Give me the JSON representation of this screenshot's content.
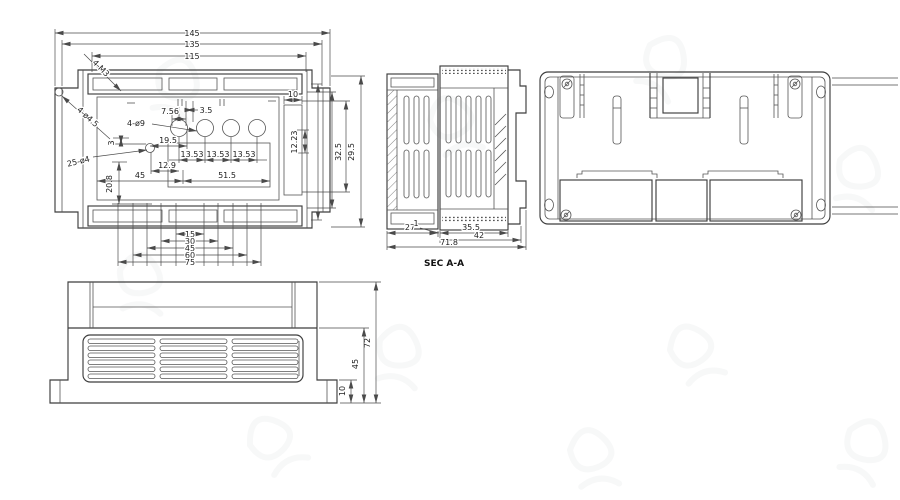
{
  "top_view": {
    "dim_145": "145",
    "dim_135": "135",
    "dim_115": "115",
    "leader_4_m3": "4-M3",
    "leader_4_d4_5": "4-ø4.5",
    "leader_4_d9": "4-ø9",
    "leader_25_d4": "25-ø4",
    "dim_7_56": "7.56",
    "dim_3_5": "3.5",
    "dim_3": "3",
    "dim_19_5": "19.5",
    "dim_20_8": "20.8",
    "dim_pitch_1": "13.53",
    "dim_pitch_2": "13.53",
    "dim_pitch_3": "13.53",
    "dim_12_9": "12.9",
    "dim_45": "45",
    "dim_51_5": "51.5",
    "dim_10": "10",
    "dim_12_23": "12.23",
    "dim_v1": "32.5",
    "dim_v2": "29.5",
    "stack": [
      "15",
      "30",
      "45",
      "60",
      "75"
    ]
  },
  "section_view": {
    "dim_27": "27",
    "dim_1": "1",
    "dim_35_5": "35.5",
    "dim_42": "42",
    "dim_71_8": "71.8",
    "label": "SEC A-A"
  },
  "front_view": {
    "dim_72": "72",
    "dim_45": "45",
    "dim_10": "10"
  }
}
